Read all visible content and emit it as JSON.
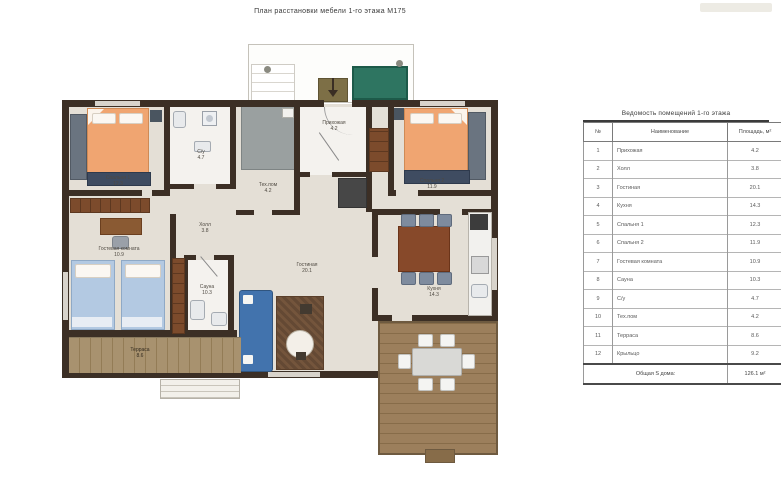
{
  "title": "План расстановки мебели 1-го этажа М175",
  "table": {
    "title": "Ведомость помещений 1-го этажа",
    "columns": [
      "№",
      "Наименование",
      "Площадь, м²"
    ],
    "rows": [
      {
        "num": "1",
        "name": "Прихожая",
        "area": "4.2"
      },
      {
        "num": "2",
        "name": "Холл",
        "area": "3.8"
      },
      {
        "num": "3",
        "name": "Гостиная",
        "area": "20.1"
      },
      {
        "num": "4",
        "name": "Кухня",
        "area": "14.3"
      },
      {
        "num": "5",
        "name": "Спальня 1",
        "area": "12.3"
      },
      {
        "num": "6",
        "name": "Спальня 2",
        "area": "11.9"
      },
      {
        "num": "7",
        "name": "Гостевая комната",
        "area": "10.9"
      },
      {
        "num": "8",
        "name": "Сауна",
        "area": "10.3"
      },
      {
        "num": "9",
        "name": "С/у",
        "area": "4.7"
      },
      {
        "num": "10",
        "name": "Тех.пом",
        "area": "4.2"
      },
      {
        "num": "11",
        "name": "Терраса",
        "area": "8.6"
      },
      {
        "num": "12",
        "name": "Крыльцо",
        "area": "9.2"
      }
    ],
    "total_label": "Общая S дома:",
    "total_value": "126.1 м²"
  },
  "plan": {
    "labels": {
      "bedroom1": {
        "name": "Спальня 1",
        "area": "12.3"
      },
      "bath1": {
        "name": "С/у",
        "area": "4.7"
      },
      "tech": {
        "name": "Тех.пом",
        "area": "4.2"
      },
      "entry": {
        "name": "Прихожая",
        "area": "4.2"
      },
      "bedroom2": {
        "name": "Спальня 2",
        "area": "11.9"
      },
      "hall": {
        "name": "Холл",
        "area": "3.8"
      },
      "guest": {
        "name": "Гостевая комната",
        "area": "10.9"
      },
      "sauna": {
        "name": "Сауна",
        "area": "10.3"
      },
      "living": {
        "name": "Гостиная",
        "area": "20.1"
      },
      "kitchen": {
        "name": "Кухня",
        "area": "14.3"
      },
      "terrace": {
        "name": "Терраса",
        "area": "8.6"
      }
    }
  },
  "colors": {
    "wall": "#3c2f25",
    "bed_orange": "#f0a571",
    "sofa_blue": "#4273ad",
    "guest_bed_blue": "#b3c9e2",
    "deck_wood": "#a8926f",
    "bench_green": "#2e7561",
    "floor_beige": "#e4dfd6"
  }
}
